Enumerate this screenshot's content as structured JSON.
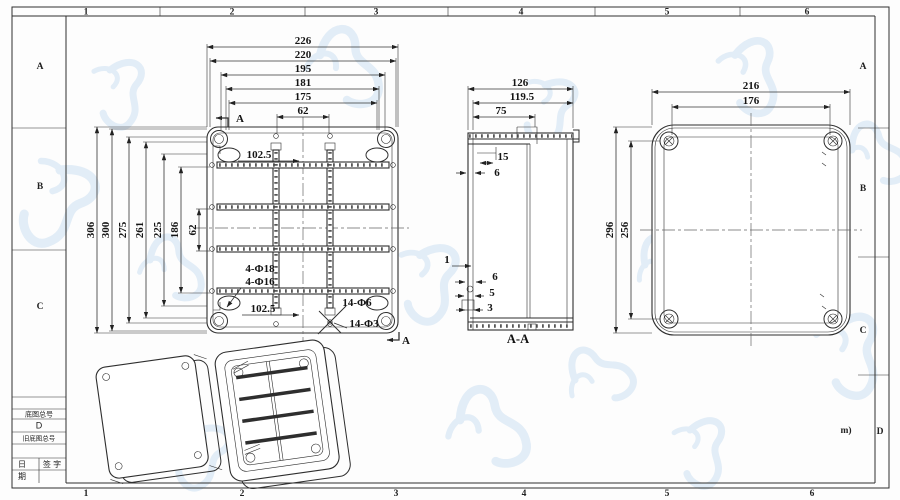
{
  "border": {
    "top_zone_labels": [
      "1",
      "2",
      "3",
      "4",
      "5",
      "6"
    ],
    "bottom_zone_labels": [
      "1",
      "2",
      "3",
      "4",
      "5",
      "6"
    ],
    "left_zone_labels": [
      "A",
      "B",
      "C"
    ],
    "right_zone_labels": [
      "A",
      "B",
      "C",
      "D"
    ],
    "revision_note": "m)"
  },
  "title_block": {
    "row1": "底图总号",
    "row2": "D",
    "row3": "旧底图总号",
    "date_top": "日",
    "date_bottom": "期",
    "sign": "签 字"
  },
  "front_view": {
    "top_dims": [
      "226",
      "220",
      "195",
      "181",
      "175",
      "62"
    ],
    "left_dims": [
      "306",
      "300",
      "275",
      "261",
      "225",
      "186",
      "62"
    ],
    "offset_top": "102.5",
    "offset_bottom": "102.5",
    "holes_large": "4-Φ18",
    "holes_medium": "4-Φ16",
    "holes_small": "14-Φ6",
    "holes_tiny": "14-Φ3",
    "section_label": "A"
  },
  "section_view": {
    "top_dims": [
      "126",
      "119.5",
      "75"
    ],
    "lip_dim": "15",
    "wall_dim_top": "6",
    "rib_dim": "1",
    "wall_dim_a": "6",
    "wall_dim_b": "5",
    "wall_dim_c": "3",
    "caption": "A-A"
  },
  "back_view": {
    "top_dims": [
      "216",
      "176"
    ],
    "left_dims": [
      "296",
      "256"
    ]
  }
}
